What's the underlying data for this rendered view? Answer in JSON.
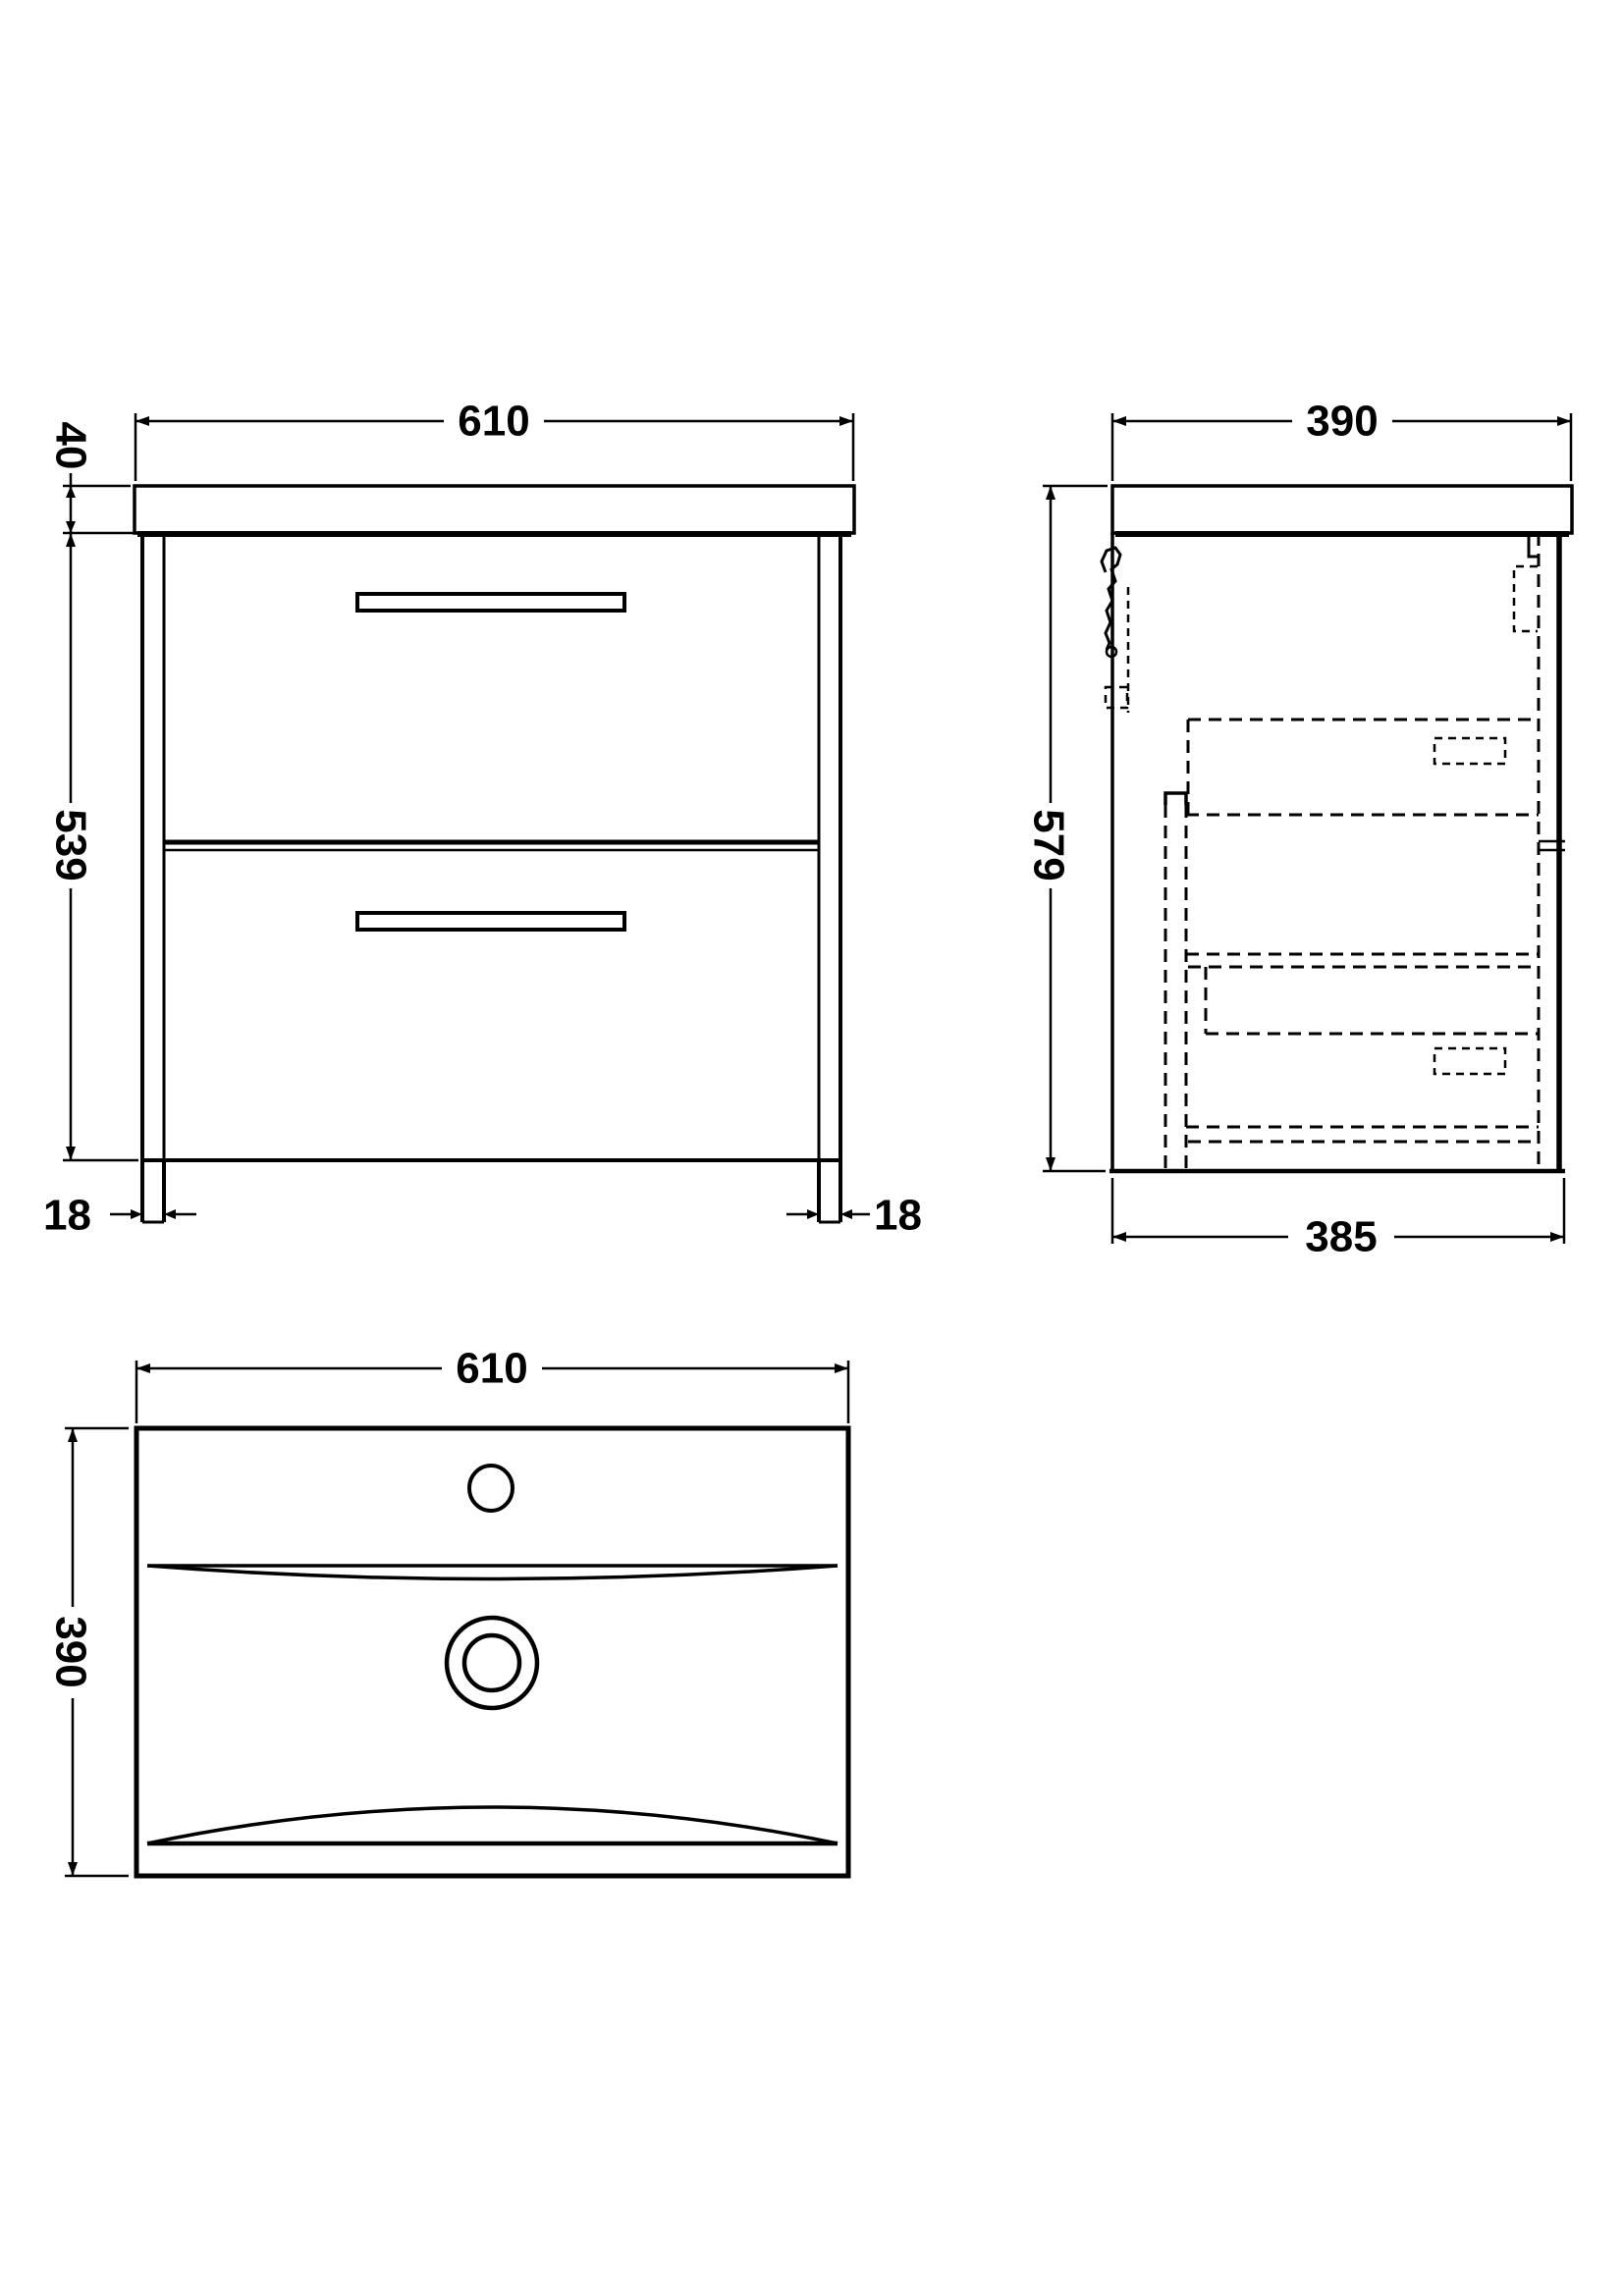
{
  "colors": {
    "background": "#ffffff",
    "ink": "#000000"
  },
  "front_view": {
    "width": "610",
    "worktop_thickness": "40",
    "cabinet_height": "539",
    "panel_left": "18",
    "panel_right": "18"
  },
  "side_view": {
    "worktop_depth": "390",
    "overall_height": "579",
    "cabinet_depth": "385"
  },
  "plan_view": {
    "basin_width": "610",
    "basin_depth": "390"
  }
}
